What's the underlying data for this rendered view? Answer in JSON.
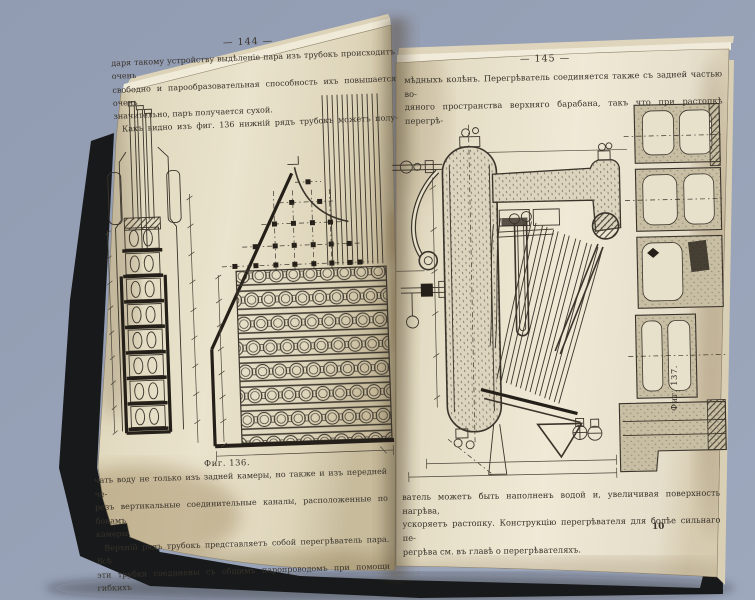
{
  "left_page": {
    "header": "— 144 —",
    "para1_lines": [
      "даря такому устройству выдѣленіе пара изъ трубокъ происходитъ очень",
      "свободно и парообразовательная способность ихъ повышается очень"
    ],
    "para1_last": "значительно, паръ получается сухой.",
    "para2_lines": [
      " Какъ видно изъ фиг. 136 нижній рядъ трубокъ можетъ полу-"
    ],
    "figure_caption": "Фиг. 136.",
    "para3_lines": [
      "чать воду не только изъ задней камеры, но также и изъ передней че-",
      "резъ вертикальные соединительные каналы, расположенные по бокамъ"
    ],
    "para3_last": "камеры.",
    "para4_lines": [
      " Верхній рядъ трубокъ представляетъ собой перегрѣватель пара. Всѣ",
      "эти трубки соединены съ общимъ паропроводомъ при помощи гибкихъ"
    ]
  },
  "right_page": {
    "header": "— 145 —",
    "para1_lines": [
      "мѣдныхъ колѣнъ. Перегрѣватель соединяется также съ задней частью во-",
      "дяного пространства верхняго барабана, такъ что при растопкѣ перегрѣ-"
    ],
    "figure_caption": "Фиг. 137.",
    "para2_lines": [
      "ватель можетъ быть наполненъ водой и, увеличивая поверхность нагрѣва,",
      "ускоряетъ растопку. Конструкцію перегрѣвателя для болѣе сильнаго пе-"
    ],
    "para2_last": "регрѣва см. въ главѣ о перегрѣвателяхъ.",
    "signature": "10"
  },
  "colors": {
    "background": "#97a1b5",
    "cover": "#17191a",
    "paper": "#e6dfc9",
    "ink": "#38322a"
  }
}
